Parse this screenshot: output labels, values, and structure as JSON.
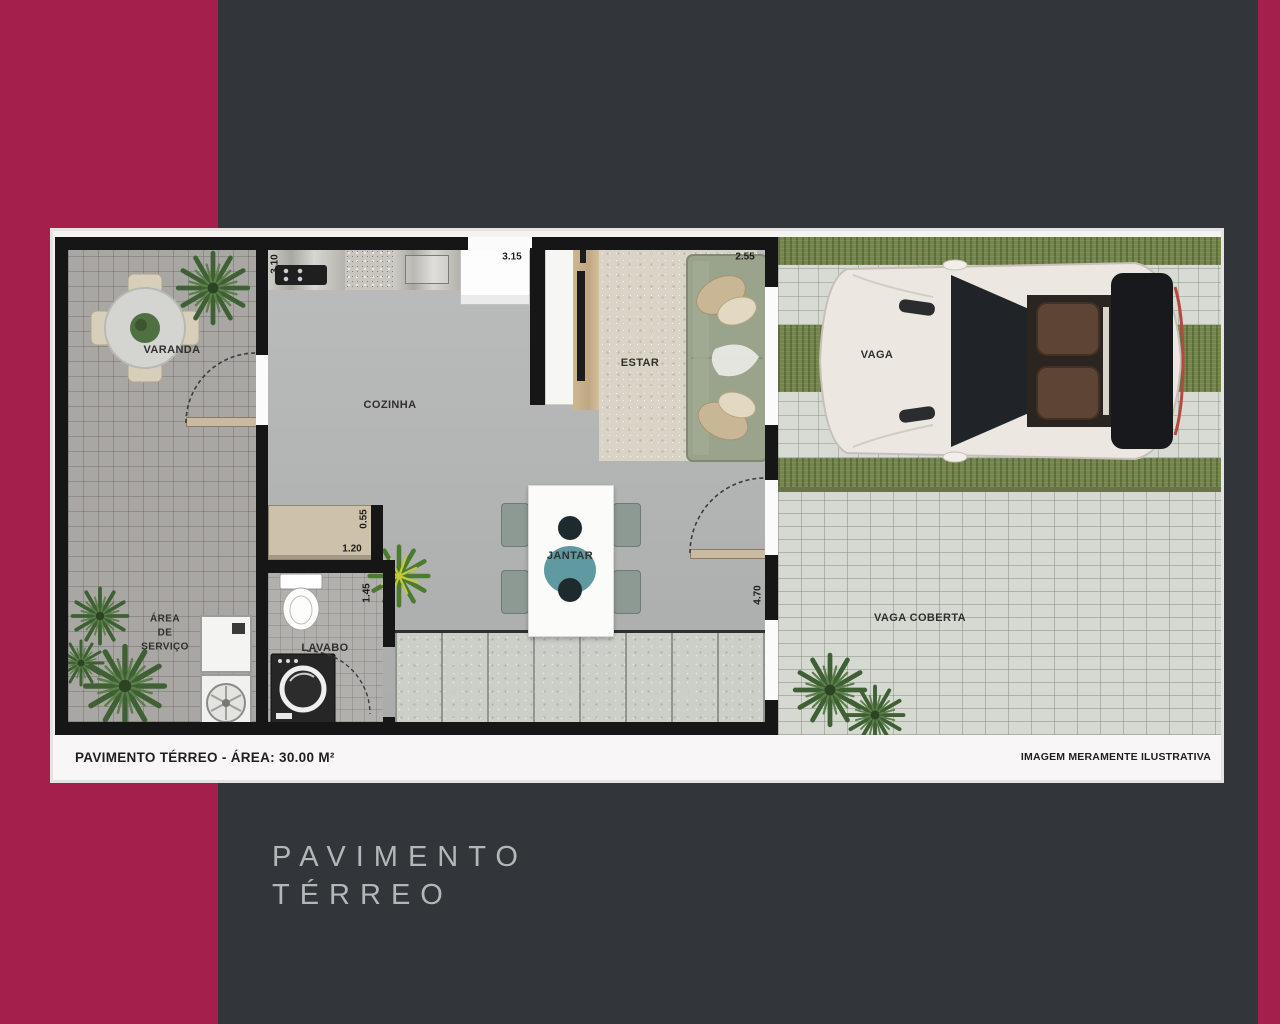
{
  "background": {
    "base_color": "#32363a",
    "accent_color": "#a51f4d",
    "plan_border_color": "#e4e3e1",
    "wall_color": "#161616",
    "grass_color": "#75854e"
  },
  "floorplan": {
    "rooms": {
      "varanda": "VARANDA",
      "cozinha": "COZINHA",
      "estar": "ESTAR",
      "jantar": "JANTAR",
      "lavabo": "LAVABO",
      "area_servico": [
        "ÁREA",
        "DE",
        "SERVIÇO"
      ],
      "vaga": "VAGA",
      "vaga_coberta": "VAGA COBERTA"
    },
    "dimensions": {
      "cozinha_left": "3.10",
      "cozinha_top": "3.15",
      "estar_top": "2.55",
      "bancada_depth": "0.55",
      "bancada_width": "1.20",
      "lavabo_width": "1.45",
      "jantar_right": "4.70"
    },
    "footer": {
      "area_label": "PAVIMENTO TÉRREO - ÁREA: 30.00 M²",
      "disclaimer": "IMAGEM MERAMENTE ILUSTRATIVA"
    }
  },
  "caption": {
    "line1": "PAVIMENTO",
    "line2": "TÉRREO"
  }
}
